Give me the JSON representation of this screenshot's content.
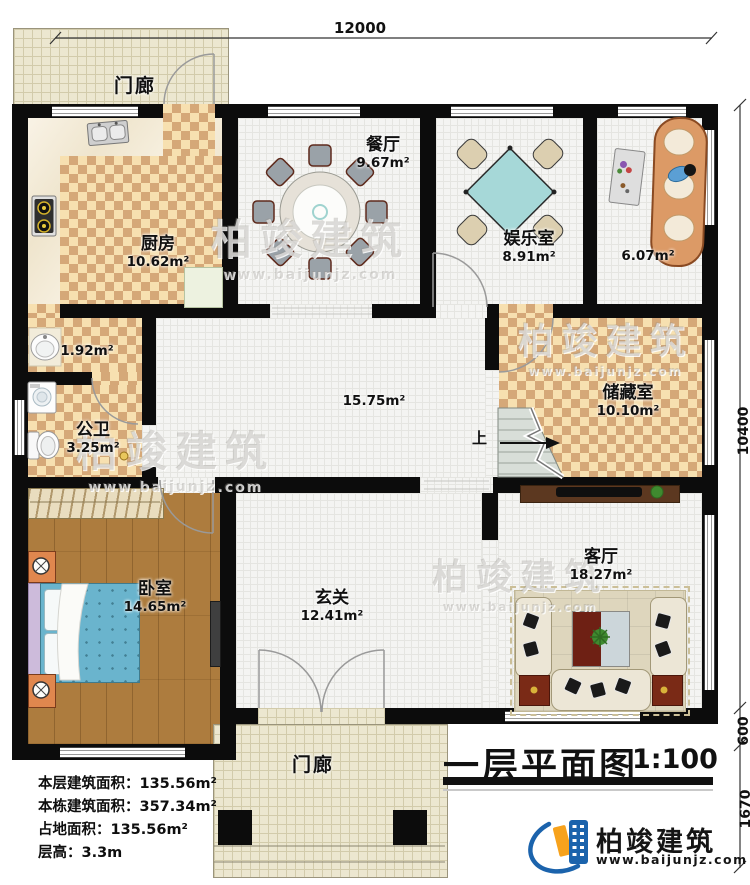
{
  "title": {
    "text": "一层平面图",
    "scale": "1:100"
  },
  "dims": {
    "top": "12000",
    "right_main": "10400",
    "right_mid": "600",
    "right_porch": "1670"
  },
  "rooms": {
    "porch_top": {
      "name": "门廊"
    },
    "kitchen": {
      "name": "厨房",
      "area": "10.62m²"
    },
    "dining": {
      "name": "餐厅",
      "area": "9.67m²"
    },
    "recreation": {
      "name": "娱乐室",
      "area": "8.91m²"
    },
    "lounge": {
      "area": "6.07m²"
    },
    "closet": {
      "area": "1.92m²"
    },
    "bathroom": {
      "name": "公卫",
      "area": "3.25m²"
    },
    "hall": {
      "area": "15.75m²"
    },
    "storage": {
      "name": "储藏室",
      "area": "10.10m²"
    },
    "bedroom": {
      "name": "卧室",
      "area": "14.65m²"
    },
    "foyer": {
      "name": "玄关",
      "area": "12.41m²"
    },
    "living": {
      "name": "客厅",
      "area": "18.27m²"
    },
    "porch_bottom": {
      "name": "门廊"
    }
  },
  "stairs": {
    "up_label": "上"
  },
  "info": {
    "line1": "本层建筑面积：135.56m²",
    "line2": "本栋建筑面积：357.34m²",
    "line3": "占地面积：135.56m²",
    "line4": "层高：3.3m"
  },
  "logo": {
    "name": "柏竣建筑",
    "url": "www.baijunjz.com"
  },
  "watermark": {
    "name": "柏竣建筑",
    "url": "www.baijunjz.com"
  },
  "colors": {
    "wall": "#0c0c0c",
    "checker_dark": "#d5a878",
    "checker_light": "#f7e0b0",
    "brand_blue": "#1b63ac",
    "brand_orange": "#f7a21c",
    "bed_teal": "#6ab4cd",
    "table_teal": "#a6d8d8"
  }
}
